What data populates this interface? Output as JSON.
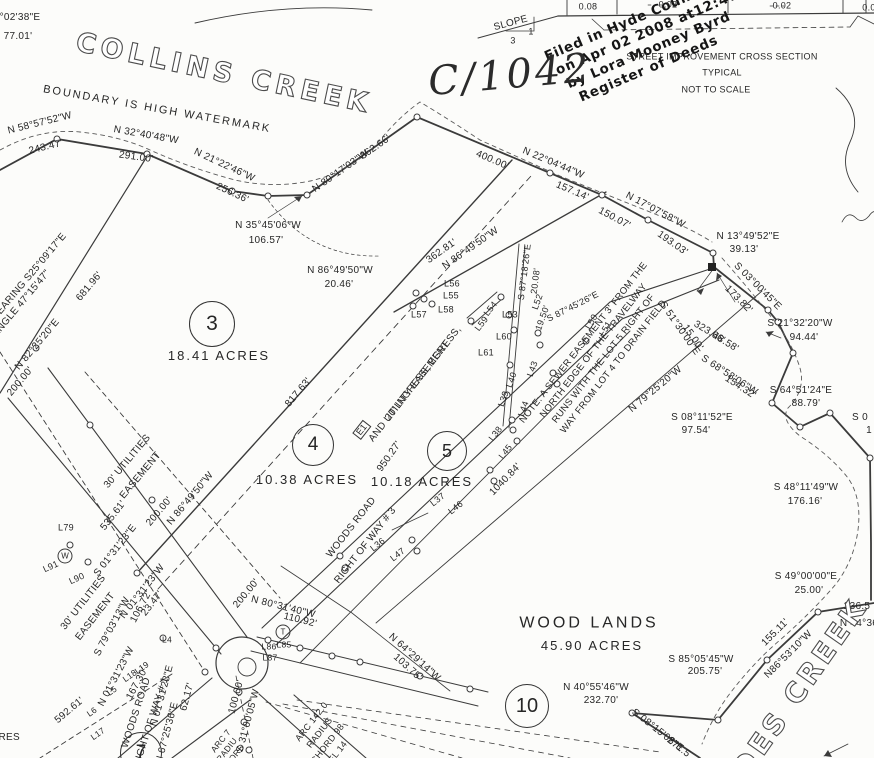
{
  "stamp": {
    "line1": "Filed in Hyde County, NC",
    "line2": "on Apr 02 2008 at12:47:29 PM",
    "line3": "by  Lora Mooney Byrd",
    "line4": "Register of Deeds"
  },
  "handwriting": {
    "book_page": "C/1042"
  },
  "lots": [
    {
      "number": "3",
      "cx": 212,
      "cy": 324,
      "r": 22,
      "acreage": "18.41 ACRES",
      "lx": 219,
      "ly": 356
    },
    {
      "number": "4",
      "cx": 313,
      "cy": 445,
      "r": 20,
      "acreage": "10.38 ACRES",
      "lx": 307,
      "ly": 480
    },
    {
      "number": "5",
      "cx": 447,
      "cy": 451,
      "r": 19,
      "acreage": "10.18 ACRES",
      "lx": 422,
      "ly": 482
    },
    {
      "number": "10",
      "cx": 527,
      "cy": 706,
      "r": 21,
      "acreage": "",
      "lx": 0,
      "ly": 0
    },
    {
      "number": "7",
      "cx": 141,
      "cy": 753,
      "r": 20,
      "acreage": "",
      "lx": 0,
      "ly": 0
    }
  ],
  "labels": [
    {
      "n": "corner-bearing",
      "t": "°02'38\"E",
      "x": 20,
      "y": 18
    },
    {
      "n": "corner-distance",
      "t": "77.01'",
      "x": 18,
      "y": 37
    },
    {
      "n": "creek-name-top",
      "t": "COLLINS CREEK",
      "x": 224,
      "y": 74,
      "r": 12,
      "s": 27,
      "c": "outline",
      "ls": 5
    },
    {
      "n": "watermark-note",
      "t": "BOUNDARY IS HIGH WATERMARK",
      "x": 157,
      "y": 110,
      "r": 10,
      "s": 11,
      "ls": 2
    },
    {
      "t": "N 58°57'52\"W",
      "x": 40,
      "y": 124,
      "r": -14
    },
    {
      "t": "243.47'",
      "x": 46,
      "y": 148,
      "r": -14
    },
    {
      "t": "N 32°40'48\"W",
      "x": 146,
      "y": 136,
      "r": 10
    },
    {
      "t": "291.00'",
      "x": 136,
      "y": 158,
      "r": 8
    },
    {
      "t": "N 21°22'46\"W",
      "x": 224,
      "y": 166,
      "r": 25
    },
    {
      "t": "256.36'",
      "x": 232,
      "y": 194,
      "r": 25
    },
    {
      "t": "N 35°45'06\"W",
      "x": 268,
      "y": 226
    },
    {
      "t": "106.57'",
      "x": 266,
      "y": 241
    },
    {
      "t": "N 80°17'03\"W",
      "x": 341,
      "y": 172,
      "r": -35
    },
    {
      "t": "362.66'",
      "x": 376,
      "y": 148,
      "r": -35
    },
    {
      "t": "400.00'",
      "x": 492,
      "y": 161,
      "r": 23
    },
    {
      "t": "N 22°04'44\"W",
      "x": 553,
      "y": 164,
      "r": 23
    },
    {
      "t": "157.14'",
      "x": 572,
      "y": 192,
      "r": 23
    },
    {
      "t": "N 17°07'58\"W",
      "x": 655,
      "y": 211,
      "r": 28
    },
    {
      "t": "150.07'",
      "x": 614,
      "y": 219,
      "r": 28
    },
    {
      "t": "193.03'",
      "x": 672,
      "y": 244,
      "r": 35
    },
    {
      "t": "N 13°49'52\"E",
      "x": 748,
      "y": 237
    },
    {
      "t": "39.13'",
      "x": 744,
      "y": 250
    },
    {
      "t": "S 03°00'45\"E",
      "x": 757,
      "y": 287,
      "r": 45
    },
    {
      "t": "173.82'",
      "x": 738,
      "y": 300,
      "r": 45
    },
    {
      "t": "S 51°30'00\"E",
      "x": 679,
      "y": 329,
      "r": 55
    },
    {
      "t": "15.00'",
      "x": 692,
      "y": 338,
      "r": 55
    },
    {
      "t": "323.66'",
      "x": 709,
      "y": 333,
      "r": 31
    },
    {
      "t": "48.58'",
      "x": 725,
      "y": 343,
      "r": 31
    },
    {
      "t": "S 21°32'20\"W",
      "x": 800,
      "y": 324
    },
    {
      "t": "94.44'",
      "x": 804,
      "y": 338
    },
    {
      "t": "S 68°58'06\"W",
      "x": 729,
      "y": 376,
      "r": 33
    },
    {
      "t": "154.32'",
      "x": 740,
      "y": 388,
      "r": 33
    },
    {
      "t": "S 64°51'24\"E",
      "x": 801,
      "y": 391
    },
    {
      "t": "88.79'",
      "x": 806,
      "y": 404
    },
    {
      "t": "S 08°11'52\"E",
      "x": 702,
      "y": 418
    },
    {
      "t": "97.54'",
      "x": 696,
      "y": 431
    },
    {
      "t": "N 79°25'20\"W",
      "x": 656,
      "y": 390,
      "r": -40
    },
    {
      "t": "S 0",
      "x": 860,
      "y": 418
    },
    {
      "t": "1",
      "x": 869,
      "y": 431
    },
    {
      "t": "S 48°11'49\"W",
      "x": 806,
      "y": 488
    },
    {
      "t": "176.16'",
      "x": 805,
      "y": 502
    },
    {
      "t": "S 49°00'00\"E",
      "x": 806,
      "y": 577
    },
    {
      "t": "25.00'",
      "x": 809,
      "y": 591
    },
    {
      "t": "236.5",
      "x": 857,
      "y": 607
    },
    {
      "t": "N 44°36",
      "x": 859,
      "y": 624
    },
    {
      "t": "155.11'",
      "x": 776,
      "y": 633,
      "r": -45
    },
    {
      "t": "N86°53'10\"W",
      "x": 789,
      "y": 655,
      "r": -45
    },
    {
      "t": "S 85°05'45\"W",
      "x": 701,
      "y": 660
    },
    {
      "t": "205.75'",
      "x": 705,
      "y": 672
    },
    {
      "t": "N 40°55'46\"W",
      "x": 596,
      "y": 688
    },
    {
      "t": "232.70'",
      "x": 601,
      "y": 701
    },
    {
      "t": "S 08°15'08\"E",
      "x": 657,
      "y": 731,
      "r": 38
    },
    {
      "t": "271.5",
      "x": 678,
      "y": 748,
      "r": 38
    },
    {
      "n": "creek-name-bottom",
      "t": "DES CREEK",
      "x": 800,
      "y": 688,
      "r": -55,
      "s": 28,
      "c": "outline",
      "ls": 4
    },
    {
      "n": "slope-label",
      "t": "SLOPE",
      "x": 511,
      "y": 24,
      "r": -15
    },
    {
      "t": "3",
      "x": 513,
      "y": 41,
      "s": 9
    },
    {
      "t": "1",
      "x": 531,
      "y": 32,
      "s": 9
    },
    {
      "t": "0.08",
      "x": 588,
      "y": 7,
      "s": 9
    },
    {
      "t": "0.02",
      "x": 668,
      "y": 5,
      "s": 9
    },
    {
      "t": "0.02",
      "x": 782,
      "y": 6,
      "s": 9
    },
    {
      "t": "0.0",
      "x": 869,
      "y": 8,
      "s": 9
    },
    {
      "n": "cross-section-title",
      "t": "STREET IMPROVEMENT CROSS SECTION",
      "x": 722,
      "y": 57,
      "s": 9
    },
    {
      "n": "cross-section-subtitle",
      "t": "TYPICAL",
      "x": 722,
      "y": 73,
      "s": 9
    },
    {
      "n": "cross-section-scale",
      "t": "NOT TO SCALE",
      "x": 716,
      "y": 90,
      "s": 9
    },
    {
      "t": "362.81'",
      "x": 442,
      "y": 252,
      "r": -35
    },
    {
      "t": "N 86°49'50\"W",
      "x": 471,
      "y": 249,
      "r": -35
    },
    {
      "t": "N 86°49'50\"W",
      "x": 340,
      "y": 271
    },
    {
      "t": "20.46'",
      "x": 339,
      "y": 285
    },
    {
      "t": "L56",
      "x": 452,
      "y": 284,
      "s": 9
    },
    {
      "t": "L55",
      "x": 451,
      "y": 296,
      "s": 9
    },
    {
      "t": "L58",
      "x": 446,
      "y": 310,
      "s": 9
    },
    {
      "t": "L57",
      "x": 419,
      "y": 315,
      "s": 9
    },
    {
      "t": "L54",
      "x": 491,
      "y": 309,
      "r": -52,
      "s": 9
    },
    {
      "t": "L53",
      "x": 510,
      "y": 315,
      "s": 9
    },
    {
      "t": "L59",
      "x": 482,
      "y": 324,
      "r": -52,
      "s": 9
    },
    {
      "t": "L60",
      "x": 504,
      "y": 337,
      "s": 9
    },
    {
      "t": "L61",
      "x": 486,
      "y": 353,
      "s": 9
    },
    {
      "t": "L52",
      "x": 538,
      "y": 302,
      "r": -70,
      "s": 9
    },
    {
      "t": "19.50'",
      "x": 543,
      "y": 318,
      "r": -70,
      "s": 9
    },
    {
      "t": "S 87°18'26\"E",
      "x": 525,
      "y": 272,
      "r": -83,
      "s": 9
    },
    {
      "t": "20.08'",
      "x": 536,
      "y": 281,
      "r": -83,
      "s": 9
    },
    {
      "t": "S 87°45'26\"E",
      "x": 573,
      "y": 307,
      "r": -27,
      "s": 9
    },
    {
      "t": "L51",
      "x": 606,
      "y": 329,
      "r": -60,
      "s": 9
    },
    {
      "t": "L50",
      "x": 592,
      "y": 322,
      "r": -60,
      "s": 9
    },
    {
      "t": "L43",
      "x": 533,
      "y": 369,
      "r": -70,
      "s": 9
    },
    {
      "t": "L40",
      "x": 512,
      "y": 380,
      "r": -70,
      "s": 9
    },
    {
      "t": "L39",
      "x": 504,
      "y": 399,
      "r": -70,
      "s": 9
    },
    {
      "t": "L44",
      "x": 524,
      "y": 409,
      "r": -70,
      "s": 9
    },
    {
      "t": "L38",
      "x": 496,
      "y": 434,
      "r": -52,
      "s": 9
    },
    {
      "t": "L45",
      "x": 506,
      "y": 452,
      "r": -52,
      "s": 9
    },
    {
      "t": "L37",
      "x": 438,
      "y": 500,
      "r": -38,
      "s": 9
    },
    {
      "t": "L46",
      "x": 456,
      "y": 508,
      "r": -38,
      "s": 9
    },
    {
      "t": "L36",
      "x": 378,
      "y": 545,
      "r": -38,
      "s": 9
    },
    {
      "t": "L47",
      "x": 398,
      "y": 555,
      "r": -38,
      "s": 9
    },
    {
      "t": "1040.84'",
      "x": 506,
      "y": 480,
      "r": -46
    },
    {
      "t": "950.27'",
      "x": 390,
      "y": 457,
      "r": -55
    },
    {
      "t": "817.63'",
      "x": 299,
      "y": 393,
      "r": -50
    },
    {
      "n": "easement-label",
      "t": "20' INGRESS, EGRESS,",
      "x": 424,
      "y": 374,
      "r": -52
    },
    {
      "n": "easement-label",
      "t": "AND UTILITY EASEMENT",
      "x": 410,
      "y": 392,
      "r": -52
    },
    {
      "n": "easement-tag",
      "t": "E1",
      "x": 362,
      "y": 430,
      "r": -52,
      "s": 9,
      "c": "boxed"
    },
    {
      "n": "road-name",
      "t": "WOODS ROAD",
      "x": 352,
      "y": 528,
      "r": -52
    },
    {
      "n": "road-name",
      "t": "RIGHT OF WAY # 3",
      "x": 366,
      "y": 546,
      "r": -52
    },
    {
      "n": "sewer-note-line",
      "t": "NOTE: A SEWER EASEMENT 3' FROM THE",
      "x": 584,
      "y": 343,
      "r": -52,
      "s": 9.5
    },
    {
      "n": "sewer-note-line",
      "t": "NORTH EDGE OF THE TRAVELWAY",
      "x": 594,
      "y": 351,
      "r": -52,
      "s": 9.5
    },
    {
      "n": "sewer-note-line",
      "t": "RUNS WITH THE LOT 5 RIGHT OF",
      "x": 604,
      "y": 359,
      "r": -52,
      "s": 9.5
    },
    {
      "n": "sewer-note-line",
      "t": "WAY FROM LOT 4 TO DRAIN FIELD",
      "x": 614,
      "y": 367,
      "r": -52,
      "s": 9.5
    },
    {
      "t": "BEARING S25°09'17\"E",
      "x": 30,
      "y": 277,
      "r": -50
    },
    {
      "t": "ANGLE 47°15'47\"",
      "x": 22,
      "y": 304,
      "r": -50
    },
    {
      "t": "681.96'",
      "x": 90,
      "y": 287,
      "r": -50
    },
    {
      "t": "N 82°25'20\"E",
      "x": 38,
      "y": 345,
      "r": -50
    },
    {
      "t": "200.00'",
      "x": 21,
      "y": 382,
      "r": -50
    },
    {
      "n": "easement-label",
      "t": "30' UTILITIES",
      "x": 128,
      "y": 462,
      "r": -50
    },
    {
      "n": "easement-label",
      "t": "EASEMENT",
      "x": 141,
      "y": 476,
      "r": -50
    },
    {
      "t": "S 01°31'23\"E",
      "x": 116,
      "y": 551,
      "r": -52
    },
    {
      "t": "535.61'",
      "x": 114,
      "y": 516,
      "r": -52
    },
    {
      "t": "N 86°49'50\"W",
      "x": 191,
      "y": 499,
      "r": -50
    },
    {
      "t": "200.00'",
      "x": 160,
      "y": 512,
      "r": -50
    },
    {
      "t": "N 01°31'23\"W",
      "x": 143,
      "y": 592,
      "r": -52
    },
    {
      "t": "23.47'",
      "x": 153,
      "y": 604,
      "r": -52
    },
    {
      "t": "L79",
      "x": 66,
      "y": 528,
      "s": 9
    },
    {
      "t": "L91",
      "x": 51,
      "y": 567,
      "r": -25,
      "s": 9
    },
    {
      "t": "L90",
      "x": 77,
      "y": 579,
      "r": -25,
      "s": 9
    },
    {
      "n": "utility-symbol",
      "t": "W",
      "x": 65,
      "y": 556,
      "s": 8,
      "c": "circled"
    },
    {
      "n": "utility-symbol",
      "t": "T",
      "x": 283,
      "y": 632,
      "s": 8,
      "c": "circled"
    },
    {
      "n": "easement-label",
      "t": "30' UTILITIES",
      "x": 84,
      "y": 603,
      "r": -52
    },
    {
      "n": "easement-label",
      "t": "EASEMENT",
      "x": 96,
      "y": 617,
      "r": -52
    },
    {
      "t": "S 79°03'13\"W",
      "x": 113,
      "y": 627,
      "r": -62
    },
    {
      "t": "106.72'",
      "x": 142,
      "y": 607,
      "r": -62
    },
    {
      "t": "N 01°31'23\"W",
      "x": 117,
      "y": 677,
      "r": -62
    },
    {
      "t": "167.30'",
      "x": 138,
      "y": 684,
      "r": -62
    },
    {
      "t": "592.61'",
      "x": 70,
      "y": 711,
      "r": -40
    },
    {
      "n": "road-name",
      "t": "WOODS ROAD",
      "x": 137,
      "y": 713,
      "r": -72
    },
    {
      "n": "road-name",
      "t": "RIGHT OF WAY # 1",
      "x": 152,
      "y": 722,
      "r": -72
    },
    {
      "t": "ACRES",
      "x": 2,
      "y": 738
    },
    {
      "t": "200.00'",
      "x": 247,
      "y": 594,
      "r": -50
    },
    {
      "t": "N 80°31'40\"W",
      "x": 283,
      "y": 608,
      "r": 14
    },
    {
      "t": "110.92'",
      "x": 300,
      "y": 621,
      "r": 14
    },
    {
      "t": "L86",
      "x": 269,
      "y": 647,
      "s": 8.5
    },
    {
      "t": "L85",
      "x": 284,
      "y": 645,
      "s": 8.5
    },
    {
      "t": "L87",
      "x": 270,
      "y": 658,
      "s": 8.5
    },
    {
      "t": "L4",
      "x": 167,
      "y": 640,
      "s": 8.5
    },
    {
      "t": "L19",
      "x": 142,
      "y": 668,
      "r": -35,
      "s": 8.5
    },
    {
      "t": "L18",
      "x": 130,
      "y": 676,
      "r": -35,
      "s": 8.5
    },
    {
      "t": "L5",
      "x": 112,
      "y": 691,
      "r": -35,
      "s": 8.5
    },
    {
      "t": "L6",
      "x": 92,
      "y": 712,
      "r": -35,
      "s": 8.5
    },
    {
      "t": "L17",
      "x": 98,
      "y": 734,
      "r": -35,
      "s": 8.5
    },
    {
      "t": "N 01°31'23\"E",
      "x": 163,
      "y": 696,
      "r": -75
    },
    {
      "t": "62.17'",
      "x": 188,
      "y": 697,
      "r": -75
    },
    {
      "t": "N 67°25'36\"E",
      "x": 168,
      "y": 733,
      "r": -75
    },
    {
      "t": "100.00'",
      "x": 237,
      "y": 697,
      "r": -75
    },
    {
      "t": "S 31°00'05\"W",
      "x": 249,
      "y": 721,
      "r": -75
    },
    {
      "t": "N 64°29'14\"W",
      "x": 414,
      "y": 658,
      "r": 42
    },
    {
      "t": "103.75'",
      "x": 407,
      "y": 668,
      "r": 42
    },
    {
      "n": "curve-data",
      "t": "ARC 142.0",
      "x": 312,
      "y": 722,
      "r": -52,
      "s": 9
    },
    {
      "n": "curve-data",
      "t": "RADIUS",
      "x": 320,
      "y": 733,
      "r": -52,
      "s": 9
    },
    {
      "n": "curve-data",
      "t": "CHORD 98",
      "x": 328,
      "y": 744,
      "r": -52,
      "s": 9
    },
    {
      "n": "curve-data",
      "t": "DEL 14",
      "x": 336,
      "y": 755,
      "r": -52,
      "s": 9
    },
    {
      "n": "curve-data",
      "t": "ARC 7",
      "x": 221,
      "y": 741,
      "r": -52,
      "s": 8.5
    },
    {
      "n": "curve-data",
      "t": "RADIU",
      "x": 227,
      "y": 750,
      "r": -52,
      "s": 8.5
    },
    {
      "n": "curve-data",
      "t": "CHORD",
      "x": 233,
      "y": 758,
      "r": -52,
      "s": 8.5
    },
    {
      "n": "woodlands-name",
      "t": "WOOD LANDS",
      "x": 589,
      "y": 624,
      "s": 16,
      "ls": 3
    },
    {
      "n": "woodlands-acreage",
      "t": "45.90 ACRES",
      "x": 592,
      "y": 646,
      "s": 13,
      "ls": 2
    }
  ]
}
